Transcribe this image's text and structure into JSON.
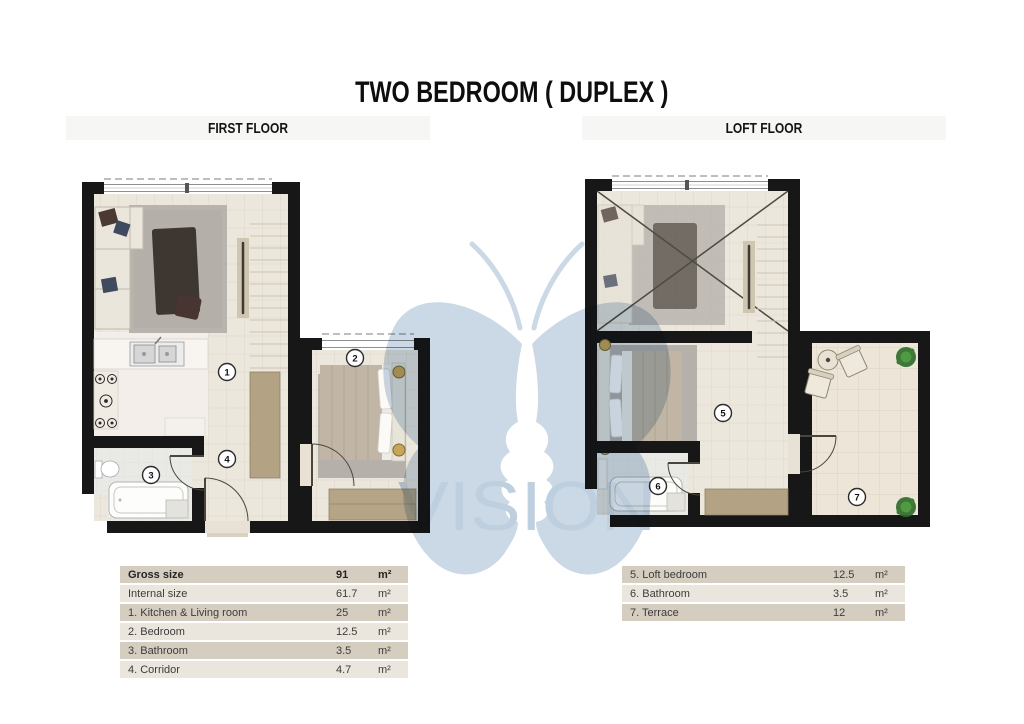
{
  "title": "TWO BEDROOM ( DUPLEX )",
  "watermark": {
    "brand": "VISION"
  },
  "floors": {
    "first": {
      "header": "FIRST FLOOR",
      "badges": [
        {
          "n": "1"
        },
        {
          "n": "2"
        },
        {
          "n": "3"
        },
        {
          "n": "4"
        }
      ],
      "table": {
        "rows": [
          {
            "label": "Gross size",
            "value": "91",
            "unit": "m²"
          },
          {
            "label": "Internal size",
            "value": "61.7",
            "unit": "m²"
          },
          {
            "label": "1. Kitchen & Living room",
            "value": "25",
            "unit": "m²"
          },
          {
            "label": "2. Bedroom",
            "value": "12.5",
            "unit": "m²"
          },
          {
            "label": "3. Bathroom",
            "value": "3.5",
            "unit": "m²"
          },
          {
            "label": "4. Corridor",
            "value": "4.7",
            "unit": "m²"
          }
        ]
      }
    },
    "loft": {
      "header": "LOFT FLOOR",
      "badges": [
        {
          "n": "5"
        },
        {
          "n": "6"
        },
        {
          "n": "7"
        }
      ],
      "table": {
        "rows": [
          {
            "label": "5. Loft bedroom",
            "value": "12.5",
            "unit": "m²"
          },
          {
            "label": "6. Bathroom",
            "value": "3.5",
            "unit": "m²"
          },
          {
            "label": "7. Terrace",
            "value": "12",
            "unit": "m²"
          }
        ]
      }
    }
  },
  "colors": {
    "wall": "#171717",
    "wood_floor": "#ece7dd",
    "tile_floor": "#ede5d8",
    "bath_floor": "#e9e9e6",
    "kitchen_floor": "#f4eeea",
    "tan_accent": "#b3a284",
    "row_dark": "#d5cdc0",
    "row_light": "#eae6dd",
    "watermark_blue": "#c7d5e3"
  }
}
